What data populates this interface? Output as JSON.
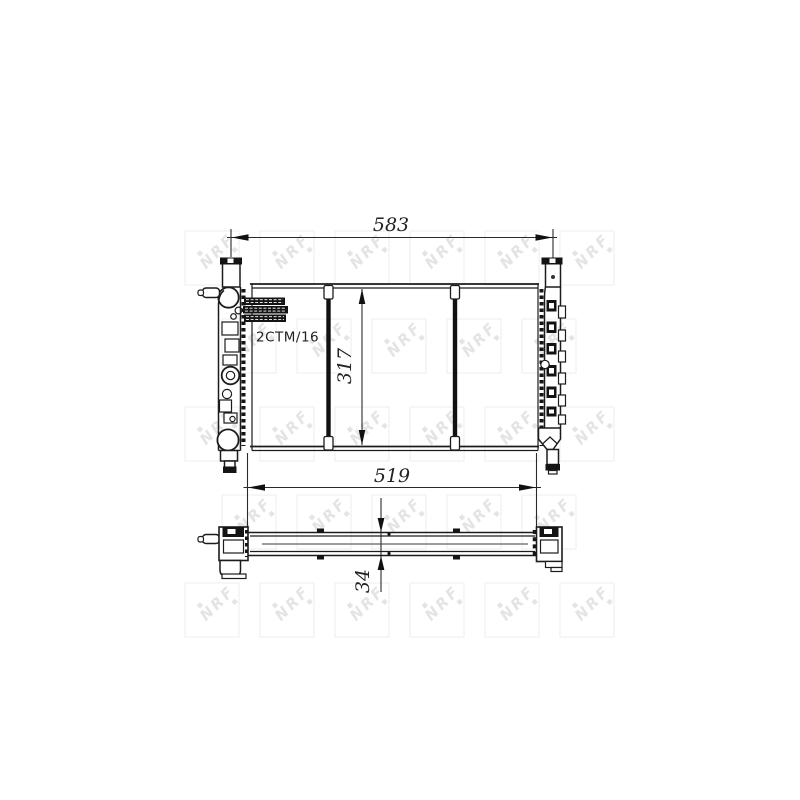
{
  "page": {
    "background": "#ffffff"
  },
  "watermark": {
    "text": "NRF",
    "logo_color": "#e4e4e4",
    "square_color": "#f1f1f1"
  },
  "drawing": {
    "product_code": "2CTM/16",
    "line_color": "#1c1c1c",
    "dimensions": {
      "overall_width": "583",
      "core_width": "519",
      "core_height": "317",
      "depth": "34"
    }
  }
}
